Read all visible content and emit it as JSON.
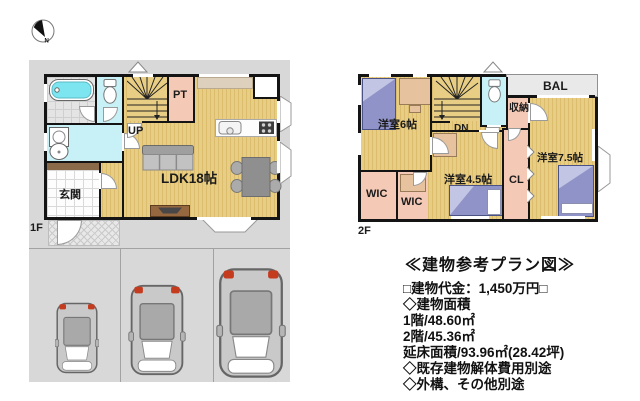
{
  "compass": {
    "north_label": "N"
  },
  "floor1": {
    "label": "1F",
    "rooms": {
      "ldk": "LDK18帖",
      "entrance": "玄関",
      "pantry": "PT",
      "stairs": "UP"
    }
  },
  "floor2": {
    "label": "2F",
    "rooms": {
      "bedroom6": "洋室6帖",
      "bedroom75": "洋室7.5帖",
      "bedroom45": "洋室4.5帖",
      "wic_left": "WIC",
      "wic_right": "WIC",
      "closet": "CL",
      "storage": "収納",
      "balcony": "BAL",
      "stairs": "DN"
    }
  },
  "info": {
    "title": "≪建物参考プラン図≫",
    "lines": [
      "□建物代金：1,450万円□",
      "◇建物面積",
      "1階/48.60㎡",
      "2階/45.36㎡",
      "延床面積/93.96㎡(28.42坪)",
      "◇既存建物解体費用別途",
      "◇外構、その他別途"
    ]
  },
  "colors": {
    "wall": "#141414",
    "wood": "#e8cd84",
    "woodline": "#dcbd6e",
    "site": "#d8d8d8",
    "pink": "#f4c9b5",
    "cyan": "#c7f1f6",
    "tub": "#7de5ef",
    "tile": "#e4e4e4",
    "bal": "#e9e9e9",
    "bed": "#9093c8",
    "bedlight": "#c3c5e4",
    "brown": "#8a6a48",
    "counter": "#ddd0bd",
    "desk": "#e7c29e",
    "accentred": "#c43b1e"
  }
}
